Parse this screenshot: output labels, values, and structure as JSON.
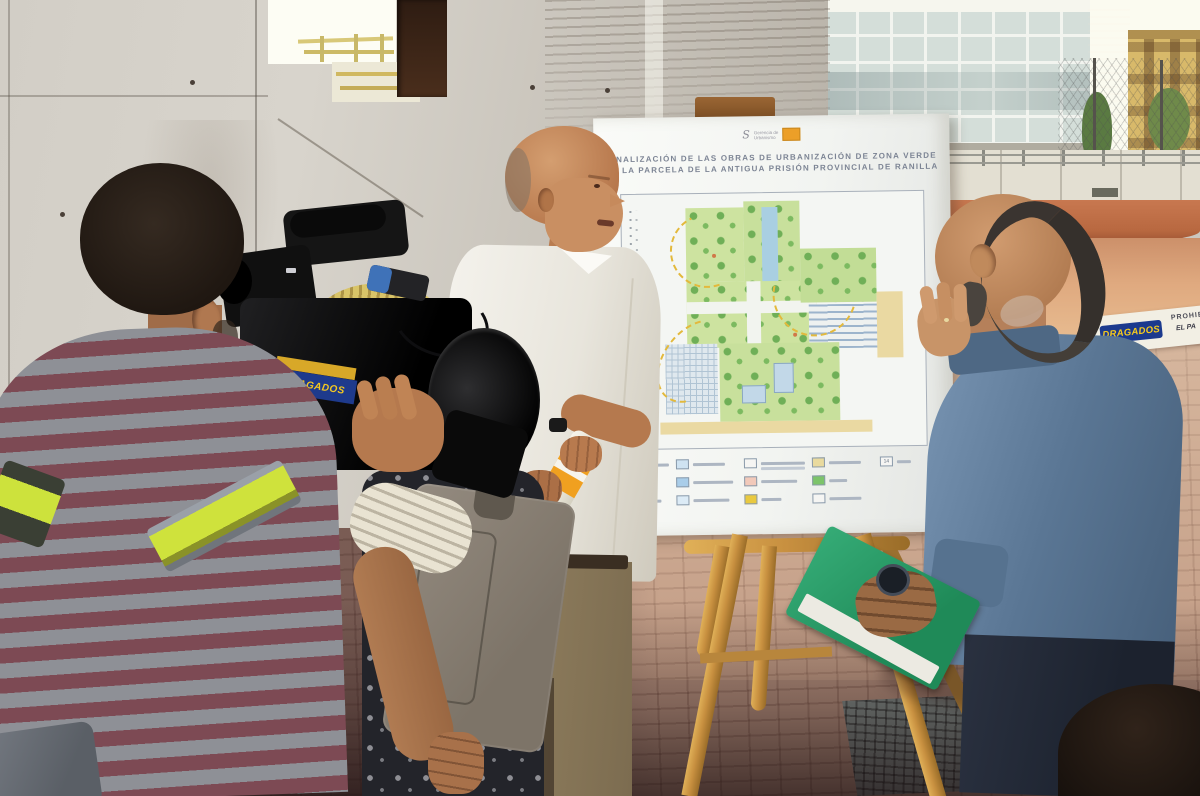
{
  "poster": {
    "logo_symbol": "S",
    "logo_line1": "Gerencia de",
    "logo_line2": "Urbanismo",
    "title_line1": "FINALIZACIÓN DE LAS OBRAS DE URBANIZACIÓN DE ZONA VERDE",
    "title_line2": "EN LA PARCELA DE LA ANTIGUA PRISIÓN PROVINCIAL DE RANILLA",
    "legend_columns": [
      {
        "chips": [
          {
            "color": "#d6e9bc",
            "lw": 44
          },
          {
            "color": "#8fc36e",
            "lw": 24
          },
          {
            "color": "#a9d6c6",
            "lw": 36
          }
        ]
      },
      {
        "chips": [
          {
            "color": "#cfe3f2",
            "lw": 32
          },
          {
            "color": "#a9cde9",
            "lw": 40
          },
          {
            "color": "#dcebf6",
            "lw": 36
          }
        ]
      },
      {
        "chips": [
          {
            "color": "#f5f5f3",
            "lw": 44,
            "lines": 2
          },
          {
            "color": "#f2c9ba",
            "lw": 36
          },
          {
            "color": "#e9c93f",
            "lw": 20
          }
        ]
      },
      {
        "chips": [
          {
            "color": "#e9da9e",
            "lw": 32
          },
          {
            "color": "#7cc46a",
            "lw": 18
          },
          {
            "color": "#f5f5f3",
            "lw": 32
          }
        ]
      },
      {
        "chips": [
          {
            "color": "#f5f5f3",
            "lw": 14,
            "num": "14"
          }
        ]
      }
    ],
    "plan_colors": {
      "grass": "#cde3a0",
      "grass2": "#c2dd96",
      "tree": "#6faf57",
      "water": "#a9cfe2",
      "building": "#c2d8e8",
      "plaza": "#ead9a2",
      "path": "#f2f4ef",
      "route": "#e3b93c"
    }
  },
  "signage": {
    "camera_sticker": "DRAGADOS",
    "tape_brand": "DRAGADOS",
    "tape_note1": "PROHIB",
    "tape_note2": "EL PA"
  },
  "palette": {
    "concrete": "#cbc7bf",
    "paving_sun": "#c59880",
    "paving_shade": "#6e5348",
    "dirt": "#c87850",
    "easel_wood": "#c89040",
    "shirt_white": "#f0eee8",
    "shirt_blue": "#5a7694",
    "folder_green": "#2f9e68",
    "hivis": "#cfe23c",
    "stripe_grey": "#8e9096",
    "stripe_maroon": "#7d4a54"
  }
}
